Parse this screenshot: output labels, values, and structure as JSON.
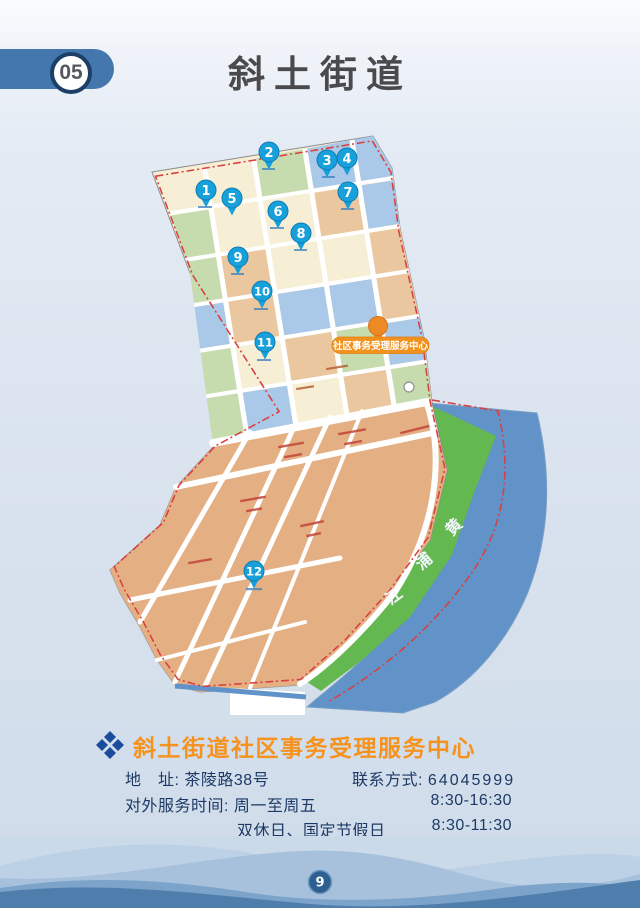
{
  "header": {
    "badge": "05",
    "title": "斜土街道"
  },
  "map": {
    "river_name": [
      "黄",
      "浦",
      "江"
    ],
    "center_label": "社区事务受理服务中心",
    "pins": [
      "1",
      "2",
      "3",
      "4",
      "5",
      "6",
      "7",
      "8",
      "9",
      "10",
      "11",
      "12"
    ],
    "icons": {
      "pin": "location-pin-icon",
      "center_pin": "service-center-pin-icon",
      "logo": "community-affairs-logo"
    },
    "colors": {
      "pin_blue": "#18a0da",
      "marker_orange": "#ee8a23",
      "river_blue": "#6193c8",
      "riverside_green": "#63b94f",
      "boundary_red": "#d94040",
      "parcel_cream": "#f7efd5",
      "parcel_green": "#c7dcae",
      "parcel_blue": "#aac8e8",
      "parcel_tan": "#ebc79f",
      "district_tan": "#e4b083"
    }
  },
  "info": {
    "title": "斜土街道社区事务受理服务中心",
    "address_label": "地　址:",
    "address_value": "茶陵路38号",
    "contact_label": "联系方式:",
    "contact_value": "64045999",
    "hours_label": "对外服务时间:",
    "weekday_value": "周一至周五",
    "weekday_time": "8:30-16:30",
    "weekend_value": "双休日、国定节假日",
    "weekend_time": "8:30-11:30",
    "accent_color": "#f6921e",
    "text_color": "#1d3a66"
  },
  "footer": {
    "page_number": "9"
  }
}
